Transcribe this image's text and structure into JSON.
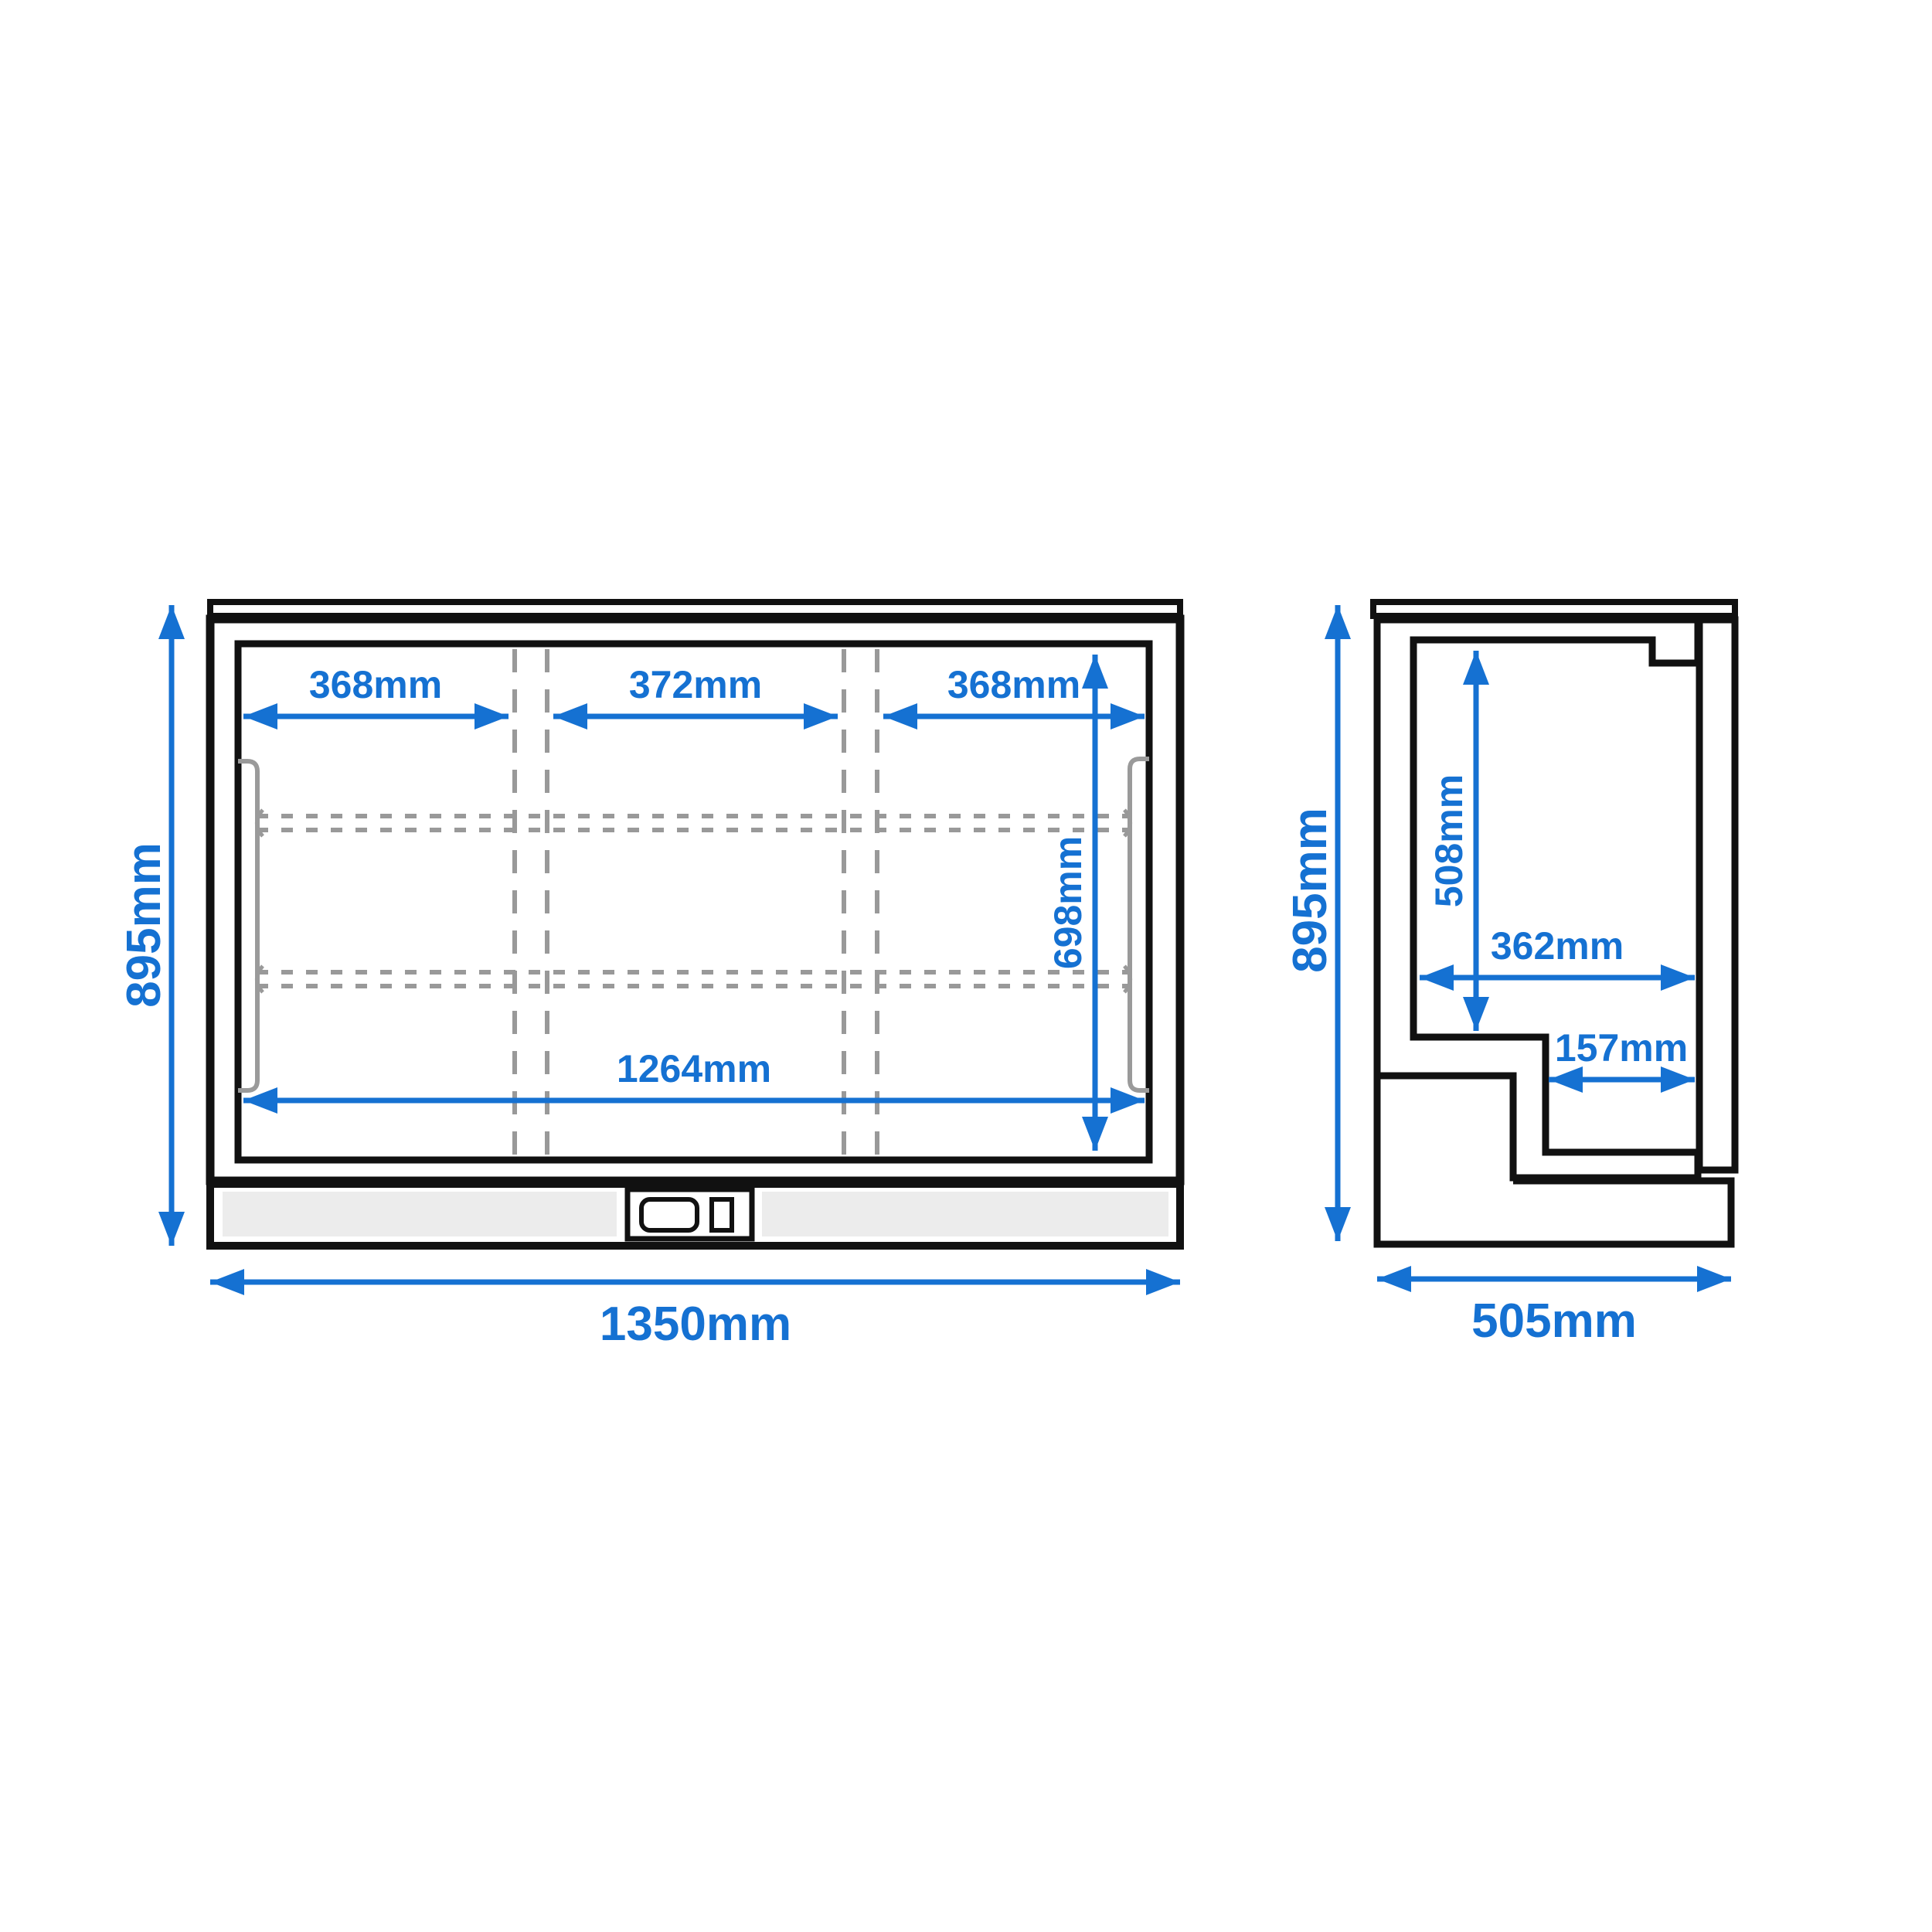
{
  "diagram": {
    "type": "technical dimension drawing",
    "subject": "back bar bottle cooler - front elevation and side section with dimensions",
    "units": "mm",
    "accent_color": "#1571d2",
    "outline_color": "#111111",
    "body_fill": "#cbcbcb",
    "kick_panel_fill": "#ececec",
    "dashed_line_color": "#999999"
  },
  "front_view": {
    "name": "front elevation",
    "overall_width": "1350mm",
    "overall_height": "895mm",
    "interior_width": "1264mm",
    "interior_height": "698mm",
    "section_widths": [
      "368mm",
      "372mm",
      "368mm"
    ]
  },
  "side_view": {
    "name": "side section",
    "overall_height": "895mm",
    "overall_depth": "505mm",
    "interior_height": "508mm",
    "interior_depth": "362mm",
    "step_depth": "157mm"
  }
}
